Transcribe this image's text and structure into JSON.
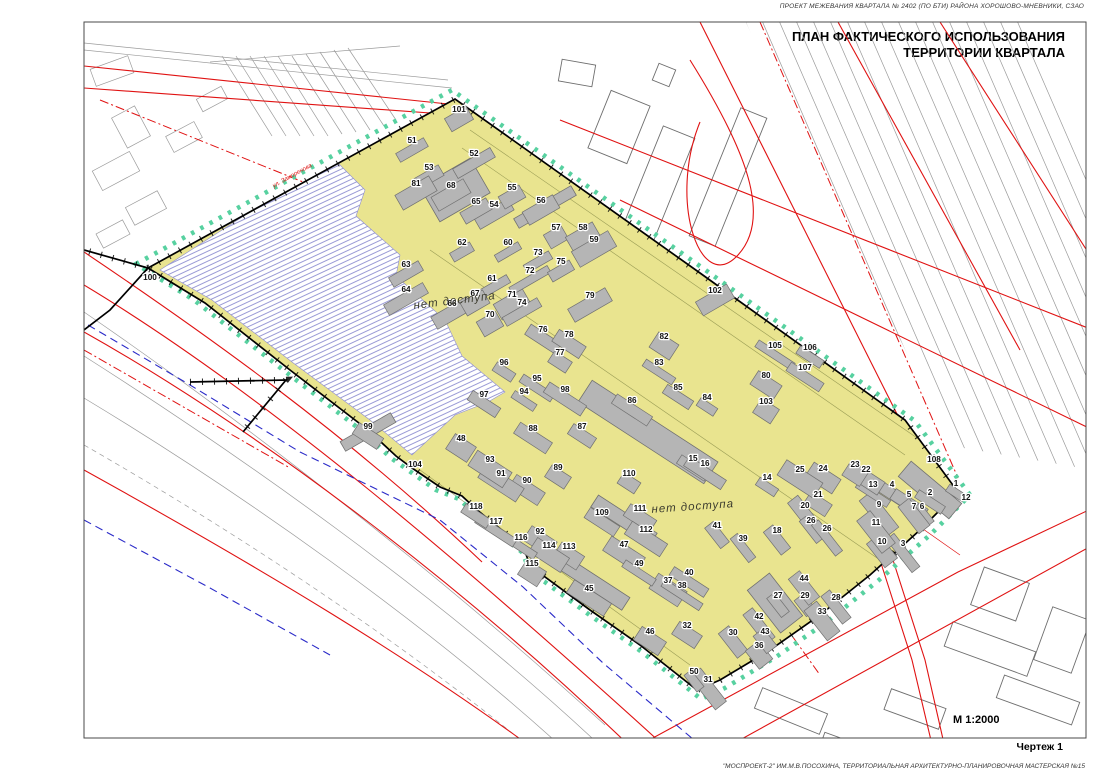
{
  "page": {
    "header": "ПРОЕКТ МЕЖЕВАНИЯ КВАРТАЛА № 2402 (ПО БТИ) РАЙОНА ХОРОШОВО-МНЕВНИКИ, СЗАО",
    "title_line1": "ПЛАН ФАКТИЧЕСКОГО ИСПОЛЬЗОВАНИЯ",
    "title_line2": "ТЕРРИТОРИИ КВАРТАЛА",
    "scale_label": "М 1:2000",
    "sheet_label": "Чертеж 1",
    "credit": "\"МОСПРОЕКТ-2\" ИМ.М.В.ПОСОХИНА,  ТЕРРИТОРИАЛЬНАЯ АРХИТЕКТУРНО-ПЛАНИРОВОЧНАЯ МАСТЕРСКАЯ №15"
  },
  "map": {
    "no_access_labels": [
      {
        "text": "нет доступа",
        "x": 455,
        "y": 304,
        "rot": -7
      },
      {
        "text": "нет доступа",
        "x": 693,
        "y": 510,
        "rot": -4
      }
    ],
    "street_label": {
      "text": "ул. Заморенова",
      "x": 293,
      "y": 177,
      "rot": -29
    },
    "colors": {
      "quarter_fill": "#e9e48f",
      "boundary_dots": "#57d1a0",
      "building_fill": "#b5b5b5",
      "building_stroke": "#707070",
      "red_line": "#e01212",
      "blue_line": "#2a2ac8",
      "hatch_line": "#8f8fd2",
      "context_gray": "#9b9b9b"
    },
    "parcels": [
      {
        "n": "1",
        "x": 956,
        "y": 486
      },
      {
        "n": "2",
        "x": 930,
        "y": 495
      },
      {
        "n": "3",
        "x": 903,
        "y": 546
      },
      {
        "n": "4",
        "x": 892,
        "y": 487
      },
      {
        "n": "5",
        "x": 909,
        "y": 497
      },
      {
        "n": "6",
        "x": 922,
        "y": 509
      },
      {
        "n": "7",
        "x": 914,
        "y": 509
      },
      {
        "n": "9",
        "x": 879,
        "y": 507
      },
      {
        "n": "10",
        "x": 882,
        "y": 544
      },
      {
        "n": "11",
        "x": 876,
        "y": 525
      },
      {
        "n": "12",
        "x": 966,
        "y": 500
      },
      {
        "n": "13",
        "x": 873,
        "y": 487
      },
      {
        "n": "14",
        "x": 767,
        "y": 480
      },
      {
        "n": "15",
        "x": 693,
        "y": 461
      },
      {
        "n": "16",
        "x": 705,
        "y": 466
      },
      {
        "n": "18",
        "x": 777,
        "y": 533
      },
      {
        "n": "20",
        "x": 805,
        "y": 508
      },
      {
        "n": "21",
        "x": 818,
        "y": 497
      },
      {
        "n": "22",
        "x": 866,
        "y": 472
      },
      {
        "n": "23",
        "x": 855,
        "y": 467
      },
      {
        "n": "24",
        "x": 823,
        "y": 471
      },
      {
        "n": "25",
        "x": 800,
        "y": 472
      },
      {
        "n": "26",
        "x": 811,
        "y": 523
      },
      {
        "n": "26",
        "x": 827,
        "y": 531
      },
      {
        "n": "27",
        "x": 778,
        "y": 598
      },
      {
        "n": "28",
        "x": 836,
        "y": 600
      },
      {
        "n": "29",
        "x": 805,
        "y": 598
      },
      {
        "n": "30",
        "x": 733,
        "y": 635
      },
      {
        "n": "31",
        "x": 708,
        "y": 682
      },
      {
        "n": "32",
        "x": 687,
        "y": 628
      },
      {
        "n": "33",
        "x": 822,
        "y": 614
      },
      {
        "n": "36",
        "x": 759,
        "y": 648
      },
      {
        "n": "37",
        "x": 668,
        "y": 583
      },
      {
        "n": "38",
        "x": 682,
        "y": 588
      },
      {
        "n": "39",
        "x": 743,
        "y": 541
      },
      {
        "n": "40",
        "x": 689,
        "y": 575
      },
      {
        "n": "41",
        "x": 717,
        "y": 528
      },
      {
        "n": "42",
        "x": 759,
        "y": 619
      },
      {
        "n": "43",
        "x": 765,
        "y": 634
      },
      {
        "n": "44",
        "x": 804,
        "y": 581
      },
      {
        "n": "45",
        "x": 589,
        "y": 591
      },
      {
        "n": "46",
        "x": 650,
        "y": 634
      },
      {
        "n": "47",
        "x": 624,
        "y": 547
      },
      {
        "n": "48",
        "x": 461,
        "y": 441
      },
      {
        "n": "49",
        "x": 639,
        "y": 566
      },
      {
        "n": "50",
        "x": 694,
        "y": 674
      },
      {
        "n": "51",
        "x": 412,
        "y": 143
      },
      {
        "n": "52",
        "x": 474,
        "y": 156
      },
      {
        "n": "53",
        "x": 429,
        "y": 170
      },
      {
        "n": "54",
        "x": 494,
        "y": 207
      },
      {
        "n": "55",
        "x": 512,
        "y": 190
      },
      {
        "n": "56",
        "x": 541,
        "y": 203
      },
      {
        "n": "57",
        "x": 556,
        "y": 230
      },
      {
        "n": "58",
        "x": 583,
        "y": 230
      },
      {
        "n": "59",
        "x": 594,
        "y": 242
      },
      {
        "n": "60",
        "x": 508,
        "y": 245
      },
      {
        "n": "61",
        "x": 492,
        "y": 281
      },
      {
        "n": "62",
        "x": 462,
        "y": 245
      },
      {
        "n": "63",
        "x": 406,
        "y": 267
      },
      {
        "n": "64",
        "x": 406,
        "y": 292
      },
      {
        "n": "65",
        "x": 476,
        "y": 204
      },
      {
        "n": "66",
        "x": 452,
        "y": 306
      },
      {
        "n": "67",
        "x": 475,
        "y": 296
      },
      {
        "n": "68",
        "x": 451,
        "y": 188
      },
      {
        "n": "70",
        "x": 490,
        "y": 317
      },
      {
        "n": "71",
        "x": 512,
        "y": 297
      },
      {
        "n": "72",
        "x": 530,
        "y": 273
      },
      {
        "n": "73",
        "x": 538,
        "y": 255
      },
      {
        "n": "74",
        "x": 522,
        "y": 305
      },
      {
        "n": "75",
        "x": 561,
        "y": 264
      },
      {
        "n": "76",
        "x": 543,
        "y": 332
      },
      {
        "n": "77",
        "x": 560,
        "y": 355
      },
      {
        "n": "78",
        "x": 569,
        "y": 337
      },
      {
        "n": "79",
        "x": 590,
        "y": 298
      },
      {
        "n": "80",
        "x": 766,
        "y": 378
      },
      {
        "n": "81",
        "x": 416,
        "y": 186
      },
      {
        "n": "82",
        "x": 664,
        "y": 339
      },
      {
        "n": "83",
        "x": 659,
        "y": 365
      },
      {
        "n": "84",
        "x": 707,
        "y": 400
      },
      {
        "n": "85",
        "x": 678,
        "y": 390
      },
      {
        "n": "86",
        "x": 632,
        "y": 403
      },
      {
        "n": "87",
        "x": 582,
        "y": 429
      },
      {
        "n": "88",
        "x": 533,
        "y": 431
      },
      {
        "n": "89",
        "x": 558,
        "y": 470
      },
      {
        "n": "90",
        "x": 527,
        "y": 483
      },
      {
        "n": "91",
        "x": 501,
        "y": 476
      },
      {
        "n": "92",
        "x": 540,
        "y": 534
      },
      {
        "n": "93",
        "x": 490,
        "y": 462
      },
      {
        "n": "94",
        "x": 524,
        "y": 394
      },
      {
        "n": "95",
        "x": 537,
        "y": 381
      },
      {
        "n": "96",
        "x": 504,
        "y": 365
      },
      {
        "n": "97",
        "x": 484,
        "y": 397
      },
      {
        "n": "98",
        "x": 565,
        "y": 392
      },
      {
        "n": "99",
        "x": 368,
        "y": 429
      },
      {
        "n": "100",
        "x": 150,
        "y": 280
      },
      {
        "n": "101",
        "x": 459,
        "y": 112
      },
      {
        "n": "102",
        "x": 715,
        "y": 293
      },
      {
        "n": "103",
        "x": 766,
        "y": 404
      },
      {
        "n": "104",
        "x": 415,
        "y": 467
      },
      {
        "n": "105",
        "x": 775,
        "y": 348
      },
      {
        "n": "106",
        "x": 810,
        "y": 350
      },
      {
        "n": "107",
        "x": 805,
        "y": 370
      },
      {
        "n": "108",
        "x": 934,
        "y": 462
      },
      {
        "n": "109",
        "x": 602,
        "y": 515
      },
      {
        "n": "110",
        "x": 629,
        "y": 476
      },
      {
        "n": "111",
        "x": 640,
        "y": 511
      },
      {
        "n": "112",
        "x": 646,
        "y": 532
      },
      {
        "n": "113",
        "x": 569,
        "y": 549
      },
      {
        "n": "114",
        "x": 549,
        "y": 548
      },
      {
        "n": "115",
        "x": 532,
        "y": 566
      },
      {
        "n": "116",
        "x": 521,
        "y": 540
      },
      {
        "n": "117",
        "x": 496,
        "y": 524
      },
      {
        "n": "118",
        "x": 476,
        "y": 509
      }
    ]
  }
}
